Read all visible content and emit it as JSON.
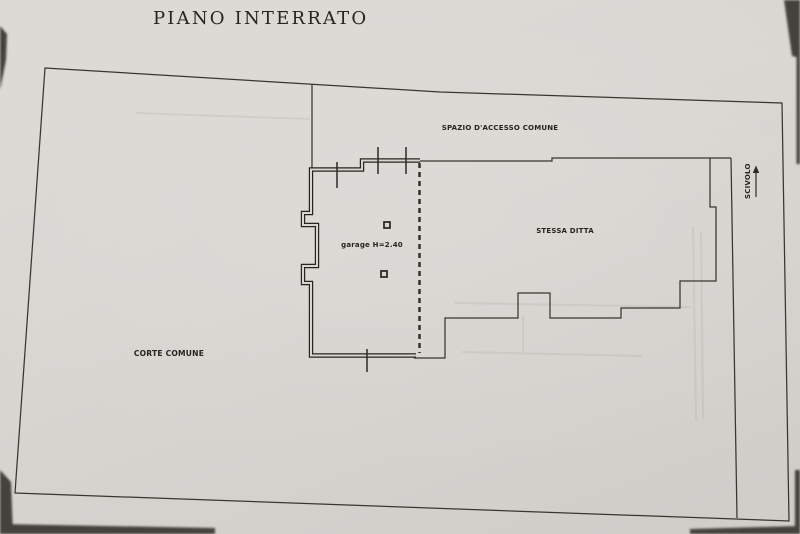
{
  "title": "PIANO INTERRATO",
  "plan": {
    "labels": {
      "access": "SPAZIO D'ACCESSO COMUNE",
      "firm": "STESSA DITTA",
      "garage": "garage H=2.40",
      "court": "CORTE COMUNE",
      "ramp": "SCIVOLO"
    }
  },
  "colors": {
    "paper": "#d8d6d1",
    "ink": "#34322e",
    "wall": "#26241d"
  }
}
